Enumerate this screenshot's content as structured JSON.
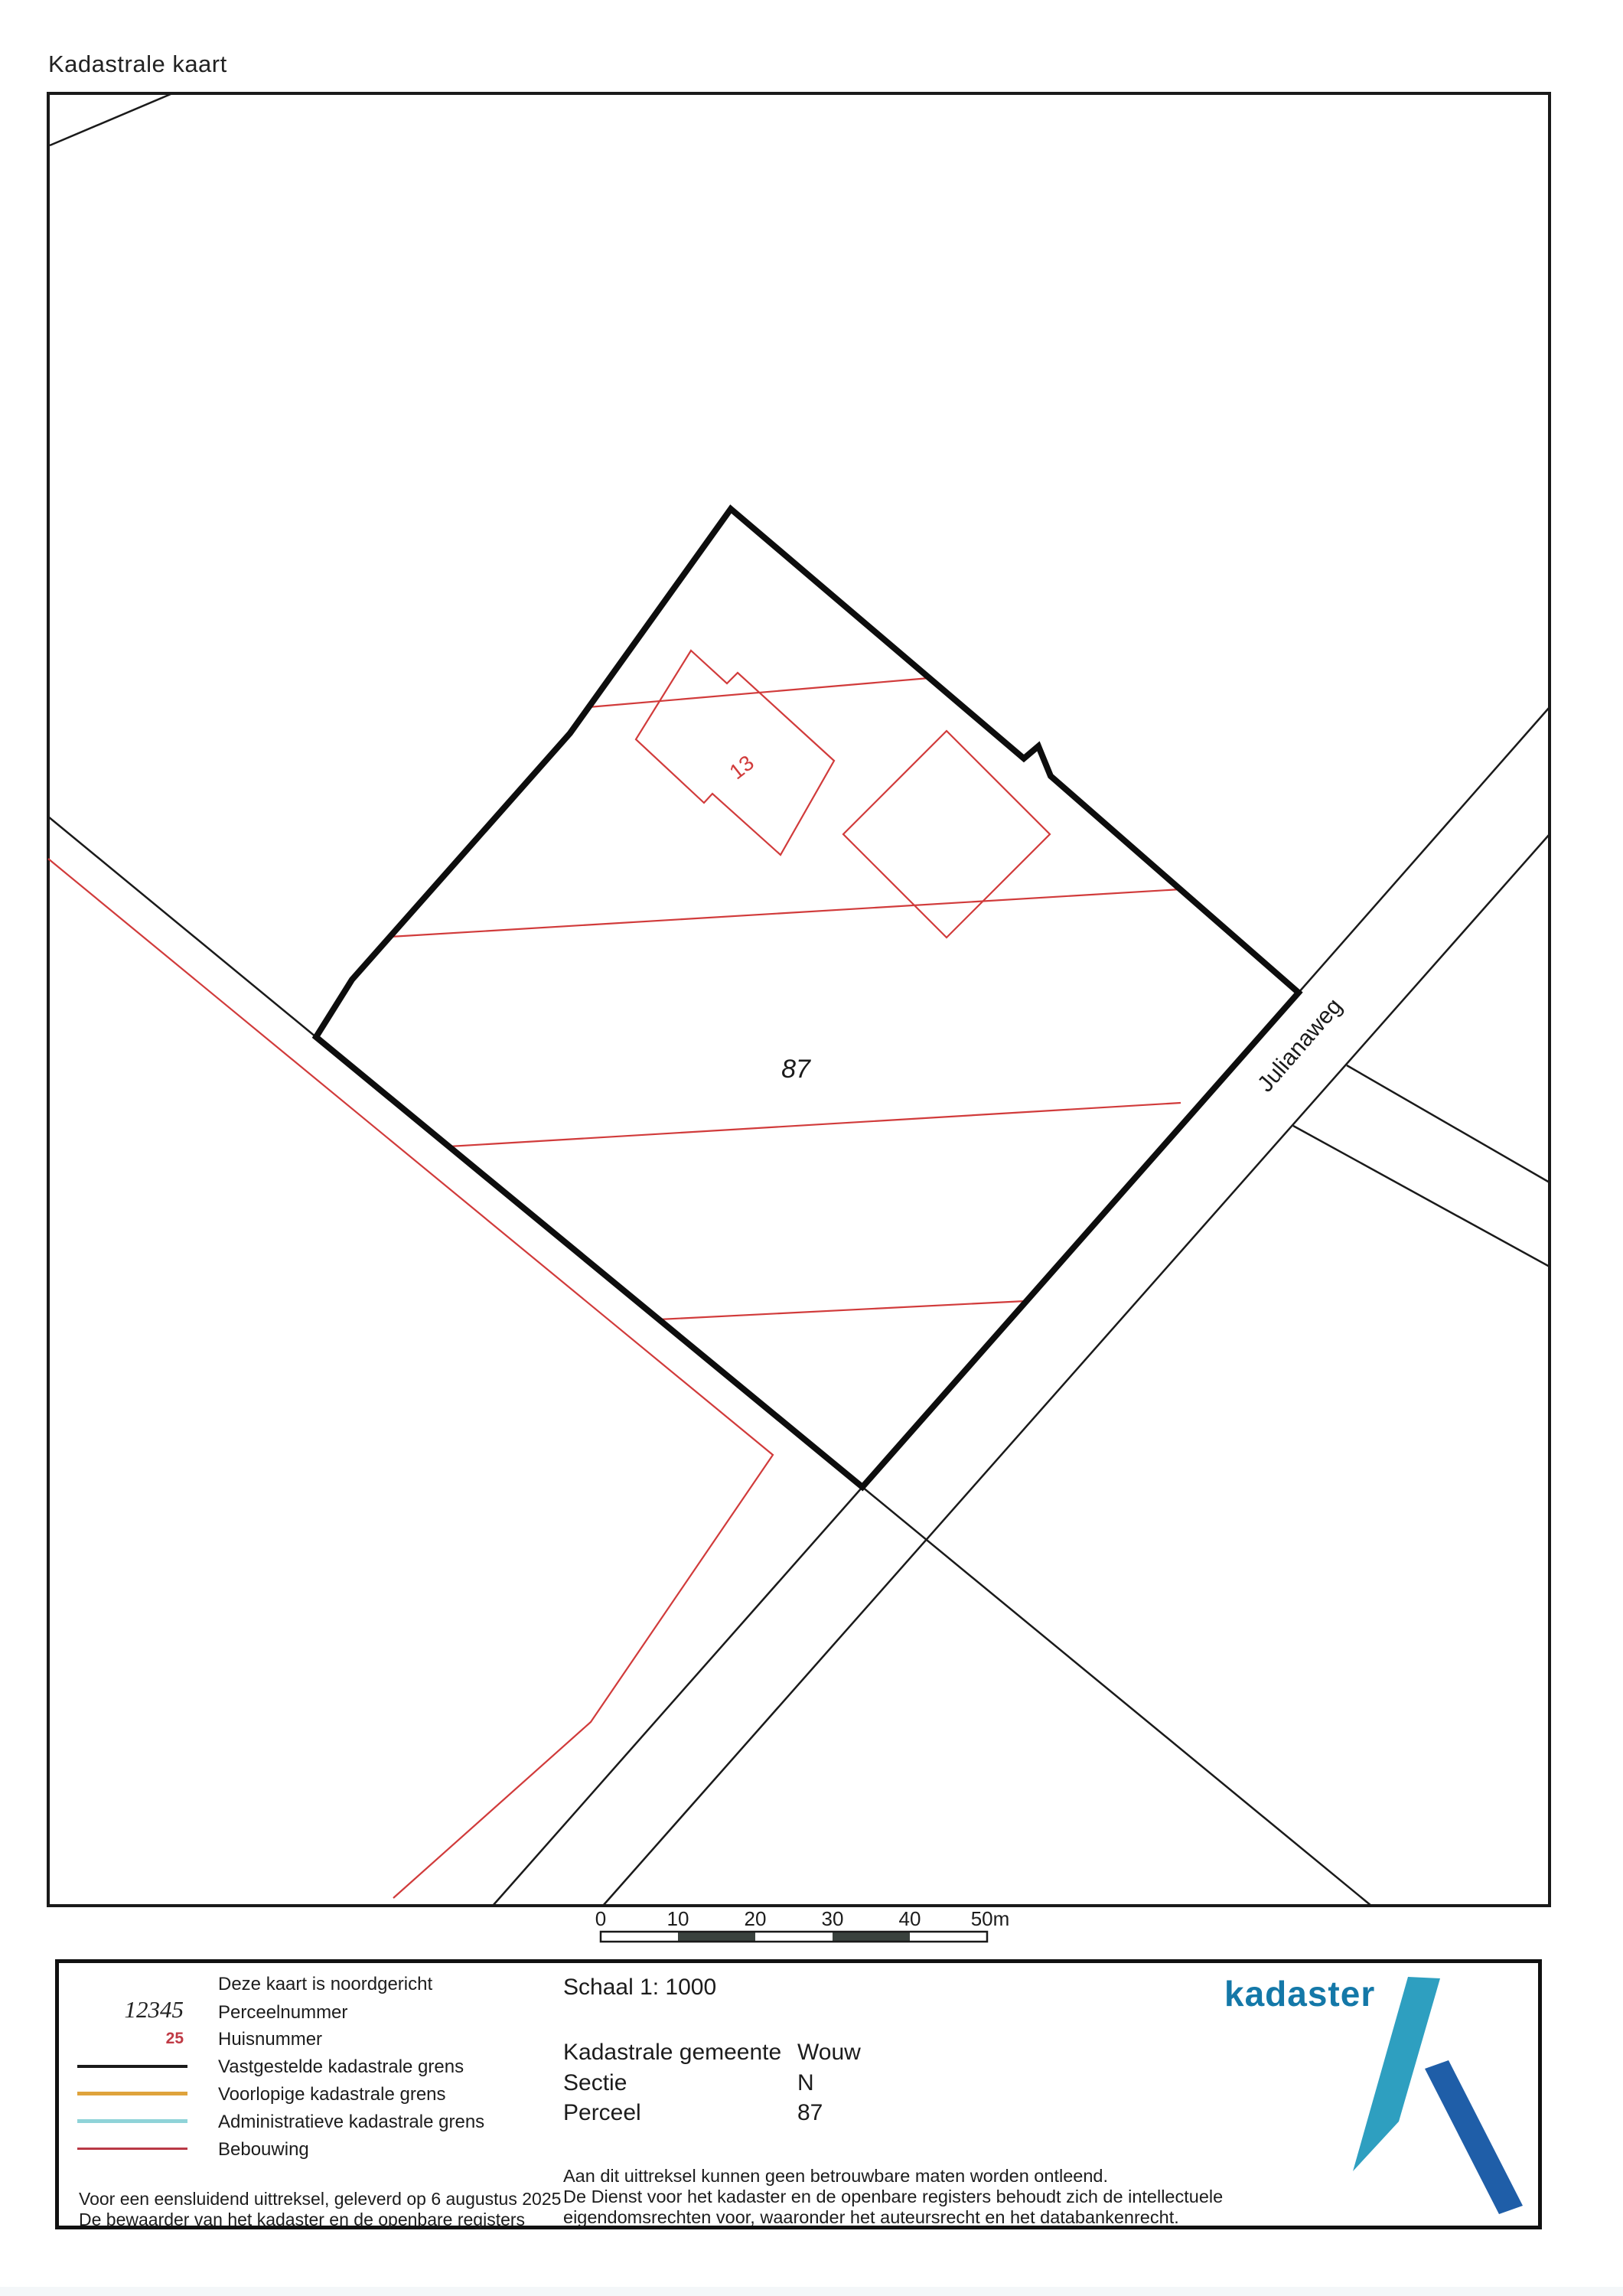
{
  "page": {
    "title": "Kadastrale kaart"
  },
  "map": {
    "parcel_number": "87",
    "house_number": "13",
    "street_name": "Julianaweg",
    "scalebar": {
      "labels": [
        "0",
        "10",
        "20",
        "30",
        "40",
        "50m"
      ]
    }
  },
  "footer": {
    "legend": {
      "north_note": "Deze kaart is noordgericht",
      "items": [
        {
          "symbol": "12345",
          "label": "Perceelnummer"
        },
        {
          "symbol": "25",
          "label": "Huisnummer"
        },
        {
          "label": "Vastgestelde kadastrale grens",
          "color": "#1a1a1a"
        },
        {
          "label": "Voorlopige kadastrale grens",
          "color": "#dfa33c"
        },
        {
          "label": "Administratieve kadastrale grens",
          "color": "#8fd3d8"
        },
        {
          "label": "Bebouwing",
          "color": "#b93945"
        }
      ],
      "issued_line1": "Voor een eensluidend uittreksel, geleverd op 6 augustus 2025",
      "issued_line2": "De bewaarder van het kadaster en de openbare registers"
    },
    "details": {
      "scale_label": "Schaal 1: 1000",
      "rows": [
        {
          "label": "Kadastrale gemeente",
          "value": "Wouw"
        },
        {
          "label": "Sectie",
          "value": "N"
        },
        {
          "label": "Perceel",
          "value": "87"
        }
      ],
      "disclaimer": [
        "Aan dit uittreksel kunnen geen betrouwbare maten worden ontleend.",
        "De Dienst voor het kadaster en de openbare registers behoudt zich de intellectuele",
        "eigendomsrechten voor, waaronder het auteursrecht en het databankenrecht."
      ]
    },
    "logo": {
      "text": "kadaster"
    }
  },
  "colors": {
    "map_black": "#1a1a1a",
    "map_red": "#d13b3b",
    "scalebar_dark": "#3a423e",
    "legend_orange": "#dfa33c",
    "legend_cyan": "#8fd3d8",
    "legend_red": "#b93945",
    "logo_text": "#1478a8",
    "logo_light": "#2e9fc0",
    "logo_dark": "#1f5ea8"
  }
}
